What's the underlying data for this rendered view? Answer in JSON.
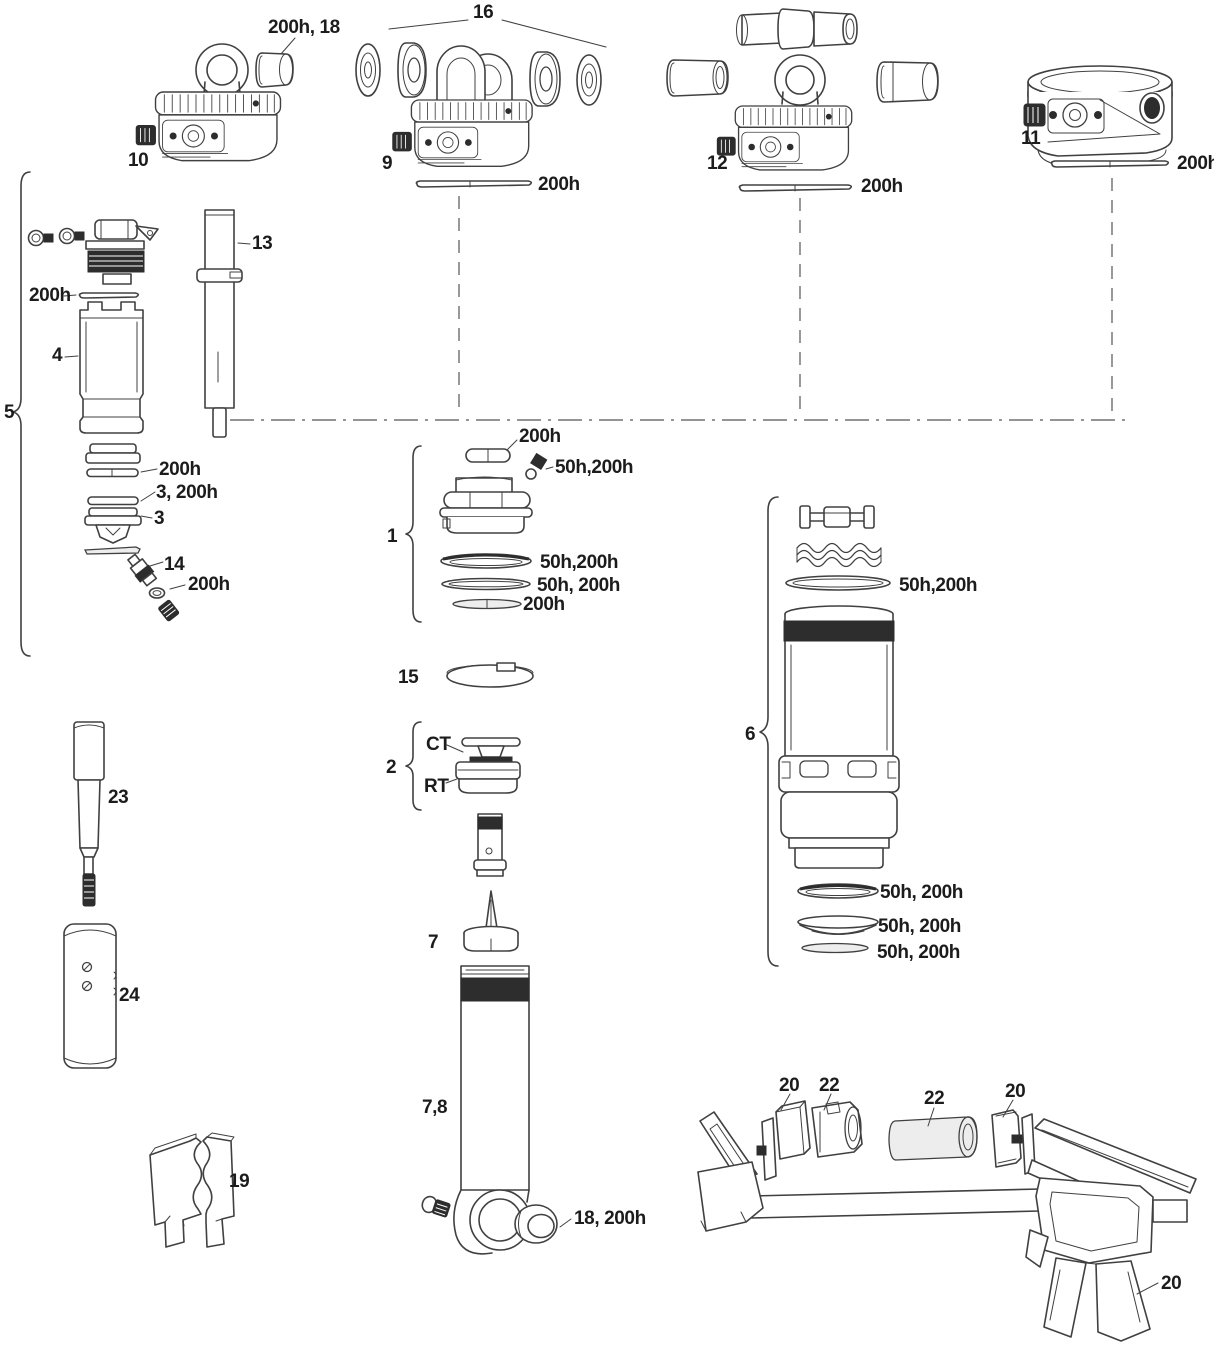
{
  "figure": {
    "kind": "exploded parts diagram",
    "subject": "rear shock damper and air can service assembly with tools",
    "background_color": "#ffffff",
    "line_color": "#404040",
    "text_color": "#1c1c1c"
  },
  "callouts": {
    "p1": "1",
    "p2": "2",
    "p3": "3",
    "p3_200h": "3, 200h",
    "p4": "4",
    "p5": "5",
    "p6": "6",
    "p7": "7",
    "p7_8": "7,8",
    "p9": "9",
    "p10": "10",
    "p11": "11",
    "p12": "12",
    "p13": "13",
    "p14": "14",
    "p15": "15",
    "p16": "16",
    "p18_200h": "18, 200h",
    "p19": "19",
    "p20": "20",
    "p22": "22",
    "p23": "23",
    "p24": "24",
    "h200": "200h",
    "h200_18": "200h, 18",
    "h50_200_tight": "50h,200h",
    "h50_200": "50h, 200h",
    "ct": "CT",
    "rt": "RT"
  }
}
